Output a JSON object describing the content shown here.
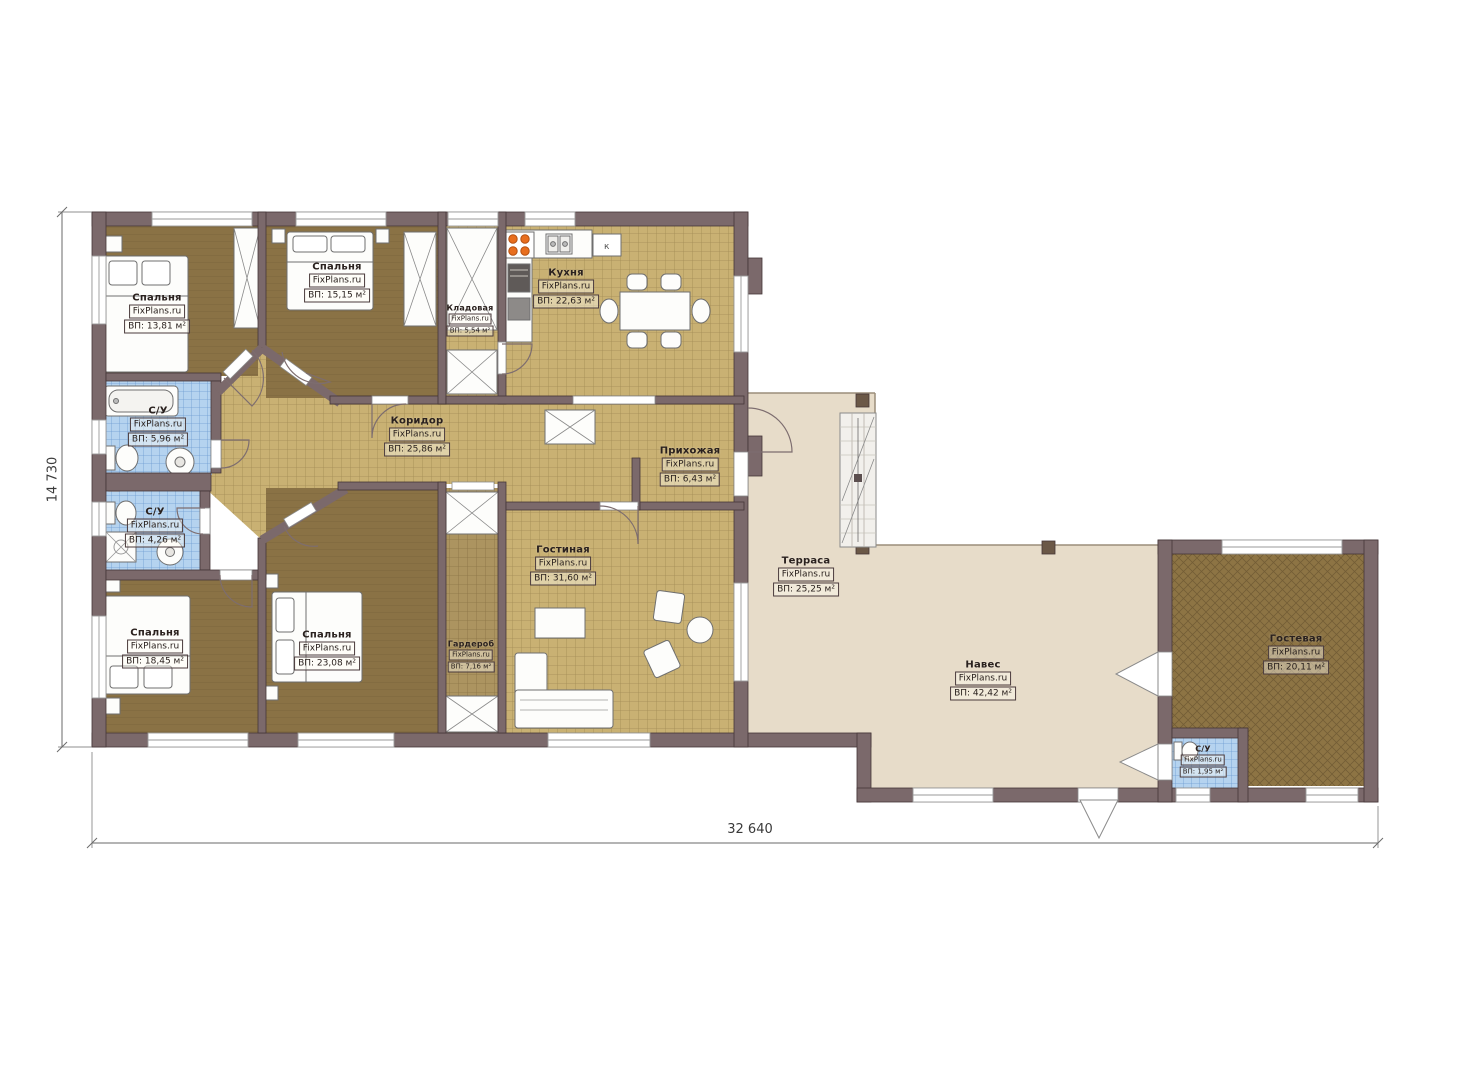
{
  "watermark": "FixPlans.ru",
  "dimensions": {
    "bottom": "32 640",
    "left": "14 730"
  },
  "kitchen_fridge_label": "к",
  "colors": {
    "wall": "#7b696b",
    "tile_floor": "#c9b173",
    "bedroom_floor": "#8a7245",
    "bath_tile": "#b5d3ef",
    "terrace_floor": "#e7dcc9",
    "stove_accent": "#e86e1e"
  },
  "rooms": [
    {
      "id": "bedroom-1",
      "name": "Спальня",
      "area": "ВП: 13,81 м²"
    },
    {
      "id": "bedroom-2",
      "name": "Спальня",
      "area": "ВП: 15,15 м²"
    },
    {
      "id": "storage",
      "name": "Кладовая",
      "area": "ВП: 5,54 м²"
    },
    {
      "id": "kitchen",
      "name": "Кухня",
      "area": "ВП: 22,63 м²"
    },
    {
      "id": "bath-1",
      "name": "С/У",
      "area": "ВП: 5,96 м²"
    },
    {
      "id": "corridor",
      "name": "Коридор",
      "area": "ВП: 25,86 м²"
    },
    {
      "id": "hallway",
      "name": "Прихожая",
      "area": "ВП: 6,43 м²"
    },
    {
      "id": "bath-2",
      "name": "С/У",
      "area": "ВП: 4,26 м²"
    },
    {
      "id": "bedroom-3",
      "name": "Спальня",
      "area": "ВП: 18,45 м²"
    },
    {
      "id": "bedroom-4",
      "name": "Спальня",
      "area": "ВП: 23,08 м²"
    },
    {
      "id": "wardrobe",
      "name": "Гардероб",
      "area": "ВП: 7,16 м²"
    },
    {
      "id": "living",
      "name": "Гостиная",
      "area": "ВП: 31,60 м²"
    },
    {
      "id": "terrace",
      "name": "Терраса",
      "area": "ВП: 25,25 м²"
    },
    {
      "id": "canopy",
      "name": "Навес",
      "area": "ВП: 42,42 м²"
    },
    {
      "id": "guest",
      "name": "Гостевая",
      "area": "ВП: 20,11 м²"
    },
    {
      "id": "bath-3",
      "name": "С/У",
      "area": "ВП: 1,95 м²"
    }
  ]
}
